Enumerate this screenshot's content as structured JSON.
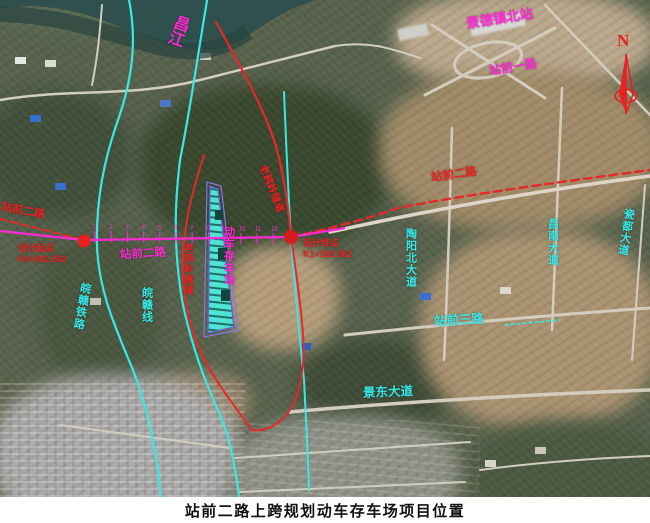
{
  "figure": {
    "caption": "站前二路上跨规划动车存车场项目位置"
  },
  "map": {
    "compass": {
      "label": "N"
    },
    "labels": {
      "river": "昌江",
      "north_station": "景德镇北站",
      "station_road_1": "站前一路",
      "station_road_2_left_red": "站前二路",
      "station_road_2_center": "站前二路",
      "station_road_2_right_red": "站前二路",
      "station_road_3": "站前三路",
      "emu_yard": "动车存车场",
      "tunnel_left": "老鸦岭隧道",
      "tunnel_right": "老鸦岭隧道",
      "railway_left": "皖赣铁路",
      "railway_center": "皖赣线",
      "taoyang_avenue": "陶阳北大道",
      "changnan_avenue": "昌南大道",
      "cidu_avenue": "瓷都大道",
      "jingdong_avenue": "景东大道"
    },
    "design_points": {
      "start_label": "设计起点",
      "start_chainage": "K0+082.562",
      "end_label": "设计终点",
      "end_chainage": "K1+262.562"
    },
    "alignment_tick_numbers": [
      "1",
      "2",
      "3",
      "4",
      "5",
      "6",
      "7",
      "8",
      "9",
      "10",
      "11",
      "12"
    ],
    "colors": {
      "alignment": "#ff2ad4",
      "planned_road": "#e62828",
      "rail_line": "#39e8e4",
      "yard_fill": "#4fe3d4",
      "yard_outline": "#8577e0"
    }
  }
}
